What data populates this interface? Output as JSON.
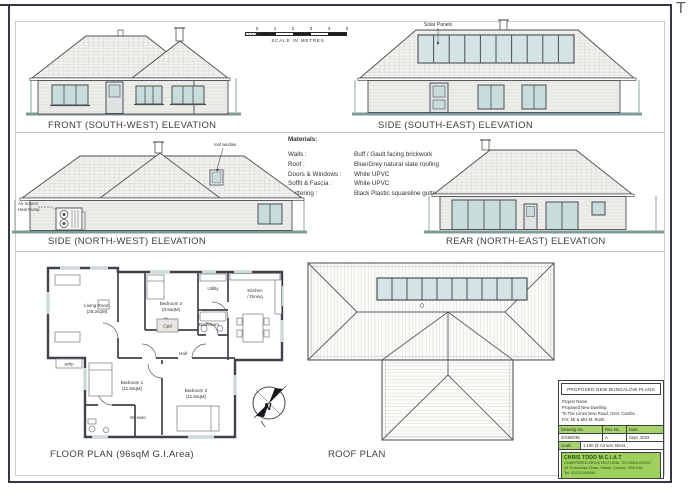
{
  "page": {
    "corner_mark": "T"
  },
  "colors": {
    "title_block_green": "#a8d36a",
    "ground_line": "#7d9b97",
    "glazing": "#c9dcdc",
    "line": "#4b4e55"
  },
  "scale_bar": {
    "ticks": [
      "0",
      "1",
      "2",
      "3",
      "4",
      "5"
    ],
    "caption": "SCALE IN METRES"
  },
  "elevations": {
    "front": {
      "label": "FRONT (SOUTH-WEST) ELEVATION"
    },
    "side_se": {
      "label": "SIDE (SOUTH-EAST) ELEVATION",
      "solar_label": "Solar Panels"
    },
    "side_nw": {
      "label": "SIDE (NORTH-WEST) ELEVATION",
      "heat_pump_line1": "Air Source",
      "heat_pump_line2": "Heat Pump",
      "roof_window_label": "roof window"
    },
    "rear": {
      "label": "REAR (NORTH-EAST) ELEVATION"
    }
  },
  "materials": {
    "title": "Materials:",
    "rows": [
      {
        "label": "Walls :",
        "value": "Buff / Gault facing brickwork"
      },
      {
        "label": "Roof :",
        "value": "Blue/Grey natural slate roofing"
      },
      {
        "label": "Doors & Windows :",
        "value": "White UPVC"
      },
      {
        "label": "Soffit & Fascia :",
        "value": "White UPVC"
      },
      {
        "label": "Guttering :",
        "value": "Black Plastic squareline guttering"
      }
    ]
  },
  "floor_plan": {
    "label": "FLOOR PLAN  (96sqM G.I.Area)",
    "compass_letter": "N",
    "rooms": {
      "living": {
        "name": "Living Room",
        "area": "(25.2sqM)"
      },
      "bedroom3": {
        "name": "Bedroom 3",
        "area": "(8.5sqM)"
      },
      "utility": {
        "name": "Utility"
      },
      "kitchen": {
        "name": "Kitchen",
        "name2": "/ Dining"
      },
      "bathroom": {
        "name": "Bathroom"
      },
      "cpd": {
        "name": "Cpd"
      },
      "hall": {
        "name": "Hall"
      },
      "bedroom1": {
        "name": "Bedroom 1",
        "area": "(11.6sqM)"
      },
      "bedroom2": {
        "name": "Bedroom 2",
        "area": "(11.5sqM)"
      },
      "ensuite": {
        "name": "En-suite"
      },
      "ashp": {
        "name": "ashp"
      }
    }
  },
  "roof_plan": {
    "label": "ROOF PLAN"
  },
  "title_block": {
    "header": "PROPOSED NEW BUNGALOW PLANS",
    "project_name_label": "Project Name",
    "project_lines": [
      "Proposed New Dwelling",
      "To  The Limes  New Road, Over, Cambs.",
      "For: Mr & Mrs M. Rush."
    ],
    "columns": {
      "drawing_no": "Drawing No.",
      "rev_no": "Rev No.",
      "date": "Date"
    },
    "values": {
      "drawing_no": "20/490/39",
      "rev_no": "A",
      "date": "Sept. 2023"
    },
    "scale_label": "Scale",
    "scale_value": "1:100  @  A3 size sheet.",
    "firm": {
      "name": "CHRIS TODD  M.C.I.A.T",
      "line2": "CHARTERED ARCHITECTURAL TECHNOLOGIST",
      "line3": "23 St Audreys Close, Histon, Cambs, CB4 9JX",
      "line4": "Tel. 01223 502499"
    }
  }
}
